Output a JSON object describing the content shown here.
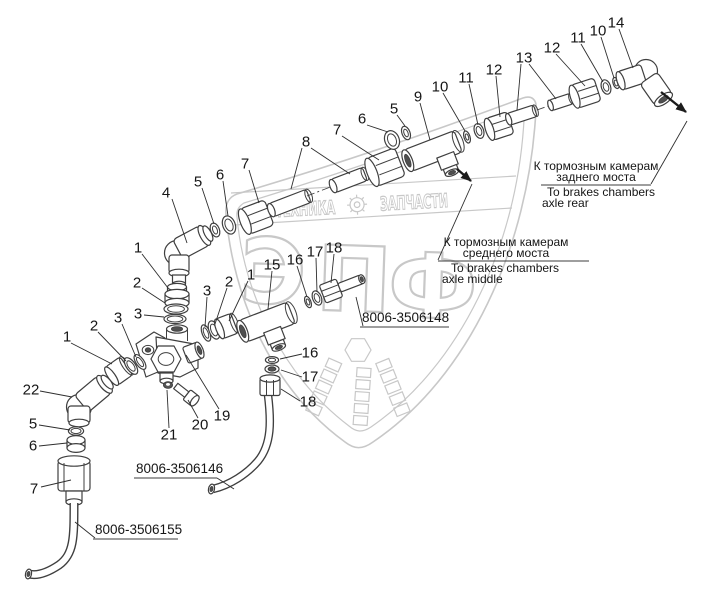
{
  "colors": {
    "line": "#3f3f3f",
    "label": "#161616",
    "watermark": "#c8c8c8",
    "background": "#ffffff"
  },
  "watermark": {
    "band_left": "ТЕХНИКА",
    "band_right": "ЗАПЧАСТИ",
    "monogram": [
      "Э",
      "П",
      "Ф"
    ]
  },
  "callouts": [
    {
      "n": "4",
      "x": 166,
      "y": 193,
      "leaders": [
        [
          172,
          199,
          187,
          243
        ]
      ]
    },
    {
      "n": "5",
      "x": 198,
      "y": 182,
      "leaders": [
        [
          202,
          188,
          214,
          224
        ]
      ]
    },
    {
      "n": "6",
      "x": 220,
      "y": 175,
      "leaders": [
        [
          223,
          181,
          228,
          216
        ]
      ]
    },
    {
      "n": "7",
      "x": 245,
      "y": 164,
      "leaders": [
        [
          249,
          170,
          259,
          203
        ]
      ]
    },
    {
      "n": "8",
      "x": 306,
      "y": 142,
      "leaders": [
        [
          302,
          148,
          291,
          189
        ],
        [
          311,
          148,
          350,
          174
        ]
      ]
    },
    {
      "n": "7",
      "x": 337,
      "y": 130,
      "leaders": [
        [
          342,
          136,
          379,
          160
        ]
      ]
    },
    {
      "n": "6",
      "x": 362,
      "y": 119,
      "leaders": [
        [
          367,
          125,
          388,
          132
        ]
      ]
    },
    {
      "n": "5",
      "x": 394,
      "y": 109,
      "leaders": [
        [
          397,
          115,
          405,
          126
        ]
      ]
    },
    {
      "n": "9",
      "x": 418,
      "y": 97,
      "leaders": [
        [
          420,
          103,
          430,
          140
        ]
      ]
    },
    {
      "n": "10",
      "x": 440,
      "y": 87,
      "leaders": [
        [
          443,
          93,
          465,
          131
        ]
      ]
    },
    {
      "n": "11",
      "x": 466,
      "y": 78,
      "leaders": [
        [
          469,
          84,
          478,
          125
        ]
      ]
    },
    {
      "n": "12",
      "x": 494,
      "y": 70,
      "leaders": [
        [
          496,
          76,
          500,
          117
        ]
      ]
    },
    {
      "n": "13",
      "x": 524,
      "y": 58,
      "leaders": [
        [
          521,
          64,
          517,
          110
        ],
        [
          529,
          64,
          556,
          99
        ]
      ]
    },
    {
      "n": "12",
      "x": 552,
      "y": 48,
      "leaders": [
        [
          556,
          54,
          585,
          86
        ]
      ]
    },
    {
      "n": "11",
      "x": 578,
      "y": 38,
      "leaders": [
        [
          581,
          44,
          603,
          82
        ]
      ]
    },
    {
      "n": "10",
      "x": 598,
      "y": 31,
      "leaders": [
        [
          601,
          37,
          614,
          78
        ]
      ]
    },
    {
      "n": "14",
      "x": 616,
      "y": 23,
      "leaders": [
        [
          619,
          29,
          633,
          68
        ]
      ]
    },
    {
      "n": "1",
      "x": 138,
      "y": 248,
      "leaders": [
        [
          142,
          254,
          168,
          288
        ]
      ]
    },
    {
      "n": "2",
      "x": 137,
      "y": 283,
      "leaders": [
        [
          142,
          288,
          165,
          303
        ]
      ]
    },
    {
      "n": "3",
      "x": 138,
      "y": 314,
      "leaders": [
        [
          144,
          315,
          164,
          317
        ]
      ]
    },
    {
      "n": "3",
      "x": 207,
      "y": 291,
      "leaders": [
        [
          207,
          297,
          205,
          327
        ]
      ]
    },
    {
      "n": "2",
      "x": 229,
      "y": 282,
      "leaders": [
        [
          227,
          288,
          215,
          324
        ]
      ]
    },
    {
      "n": "1",
      "x": 251,
      "y": 275,
      "leaders": [
        [
          248,
          281,
          229,
          321
        ]
      ]
    },
    {
      "n": "15",
      "x": 272,
      "y": 265,
      "leaders": [
        [
          272,
          271,
          268,
          309
        ]
      ]
    },
    {
      "n": "16",
      "x": 295,
      "y": 260,
      "leaders": [
        [
          297,
          266,
          307,
          297
        ]
      ]
    },
    {
      "n": "17",
      "x": 315,
      "y": 252,
      "leaders": [
        [
          316,
          258,
          317,
          292
        ]
      ]
    },
    {
      "n": "18",
      "x": 334,
      "y": 248,
      "leaders": [
        [
          334,
          254,
          331,
          283
        ]
      ]
    },
    {
      "n": "1",
      "x": 67,
      "y": 337,
      "leaders": [
        [
          71,
          343,
          112,
          364
        ]
      ]
    },
    {
      "n": "2",
      "x": 94,
      "y": 326,
      "leaders": [
        [
          98,
          332,
          126,
          361
        ]
      ]
    },
    {
      "n": "3",
      "x": 118,
      "y": 318,
      "leaders": [
        [
          122,
          324,
          136,
          357
        ]
      ]
    },
    {
      "n": "22",
      "x": 31,
      "y": 390,
      "leaders": [
        [
          40,
          391,
          72,
          397
        ]
      ]
    },
    {
      "n": "5",
      "x": 33,
      "y": 424,
      "leaders": [
        [
          39,
          425,
          70,
          430
        ]
      ]
    },
    {
      "n": "6",
      "x": 33,
      "y": 446,
      "leaders": [
        [
          39,
          446,
          67,
          443
        ]
      ]
    },
    {
      "n": "7",
      "x": 34,
      "y": 489,
      "leaders": [
        [
          41,
          487,
          71,
          480
        ]
      ]
    },
    {
      "n": "16",
      "x": 310,
      "y": 353,
      "leaders": [
        [
          302,
          354,
          280,
          359
        ]
      ]
    },
    {
      "n": "17",
      "x": 310,
      "y": 377,
      "leaders": [
        [
          302,
          377,
          281,
          370
        ]
      ]
    },
    {
      "n": "18",
      "x": 308,
      "y": 402,
      "leaders": [
        [
          300,
          401,
          281,
          389
        ]
      ]
    },
    {
      "n": "19",
      "x": 222,
      "y": 416,
      "leaders": [
        [
          219,
          409,
          186,
          355
        ]
      ]
    },
    {
      "n": "20",
      "x": 200,
      "y": 425,
      "leaders": [
        [
          198,
          418,
          188,
          400
        ]
      ]
    },
    {
      "n": "21",
      "x": 169,
      "y": 435,
      "leaders": [
        [
          169,
          428,
          167,
          390
        ]
      ]
    }
  ],
  "part_numbers": [
    {
      "text": "8006-3506148",
      "x": 362,
      "y": 322,
      "underline": [
        360,
        327,
        449,
        327
      ],
      "leader": [
        363,
        326,
        356,
        297
      ]
    },
    {
      "text": "8006-3506146",
      "x": 136,
      "y": 473,
      "underline": [
        134,
        478,
        217,
        478
      ],
      "leader": [
        217,
        478,
        234,
        489
      ]
    },
    {
      "text": "8006-3506155",
      "x": 95,
      "y": 534,
      "underline": [
        93,
        539,
        178,
        539
      ],
      "leader": [
        95,
        538,
        75,
        522
      ]
    }
  ],
  "notes": [
    {
      "ru": [
        "К тормозным камерам",
        "заднего моста"
      ],
      "en": [
        "To brakes chambers",
        "axle rear"
      ],
      "ru_cx": 596,
      "ru_y": [
        170,
        181
      ],
      "rule": [
        541,
        185,
        651,
        185
      ],
      "en_x": [
        547,
        542
      ],
      "en_y": [
        196,
        207
      ],
      "leader": [
        651,
        184,
        687,
        121
      ]
    },
    {
      "ru": [
        "К тормозным камерам",
        "среднего моста"
      ],
      "en": [
        "To brakes chambers",
        "axle middle"
      ],
      "ru_cx": 506,
      "ru_y": [
        246,
        257
      ],
      "rule": [
        438,
        261,
        589,
        261
      ],
      "en_x": [
        451,
        442
      ],
      "en_y": [
        272,
        283
      ],
      "leader": [
        438,
        260,
        472,
        184
      ]
    }
  ],
  "arrows": [
    [
      661,
      92,
      686,
      112
    ],
    [
      457,
      169,
      471,
      181
    ]
  ]
}
